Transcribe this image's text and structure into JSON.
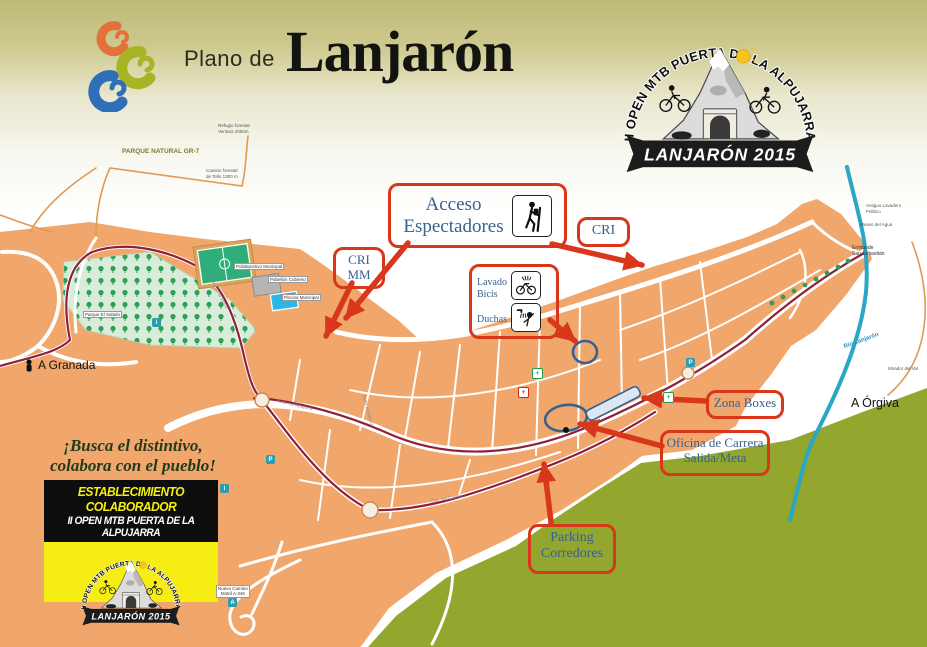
{
  "header": {
    "plano_de": "Plano de",
    "lanjaron": "Lanjarón"
  },
  "event_logo": {
    "arc_text": "II OPEN MTB PUERTA DE LA ALPUJARRA",
    "banner_text": "LANJARÓN 2015"
  },
  "annotations": {
    "acceso": {
      "line1": "Acceso",
      "line2": "Espectadores",
      "icon": "hiker-icon"
    },
    "cri": {
      "label": "CRI"
    },
    "cri_mm": {
      "line1": "CRI",
      "line2": "MM"
    },
    "lavado": {
      "line1": "Lavado",
      "line2": "Bicis",
      "line3": "Duchas",
      "icons": [
        "bike-wash-icon",
        "shower-icon"
      ]
    },
    "zona_boxes": {
      "label": "Zona Boxes"
    },
    "oficina": {
      "line1": "Oficina de Carrera",
      "line2": "Salida/Meta"
    },
    "parking": {
      "line1": "Parking",
      "line2": "Corredores"
    }
  },
  "promo": {
    "slogan_line1": "¡Busca el distintivo,",
    "slogan_line2": "colabora con el pueblo!",
    "card_title": "ESTABLECIMIENTO COLABORADOR",
    "card_subtitle": "II OPEN MTB PUERTA DE LA ALPUJARRA"
  },
  "map_labels": {
    "parque_natural": "PARQUE NATURAL GR-7",
    "refugio_line1": "Refugio forestal",
    "refugio_line2": "Ventura 2000m",
    "camino_forestal_line1": "Camino forestal",
    "camino_forestal_line2": "de Tello 1300 m",
    "a_granada": "A Granada",
    "a_orgiva": "A Órgiva",
    "rio_lanjaron": "Río Lanjarón",
    "mirador": "Mirador del Val",
    "lavadero_line1": "Antiguo Lavadero",
    "lavadero_line2": "Público",
    "museo_agua": "Museo del Agua",
    "ermita_line1": "Ermita de",
    "ermita_line2": "San Sebastián",
    "parque_salado": "Parque El Salado",
    "polideportivo": "Polideportivo Municipal",
    "pabellon": "Pabellón Cubierto",
    "piscina": "Piscina Municipal",
    "motril_line1": "Nuevo Camino",
    "motril_line2": "Motril A-346",
    "avda_alpujarra": "Avda. La Alpujarra",
    "avda_andalucia": "Avda. Andalucía",
    "ctra_castillo": "Ctra. del Castillo",
    "camino_sierra": "Camino de la Sierra"
  },
  "colors": {
    "accent_red": "#d8371b",
    "annotation_text": "#37618f",
    "town_orange": "#f1a66b",
    "hill_olive": "#93a62e",
    "river_teal": "#2aa7c4",
    "route_maroon": "#8e2038",
    "card_yellow": "#f6ee12",
    "park_green": "#d9ecd9"
  }
}
